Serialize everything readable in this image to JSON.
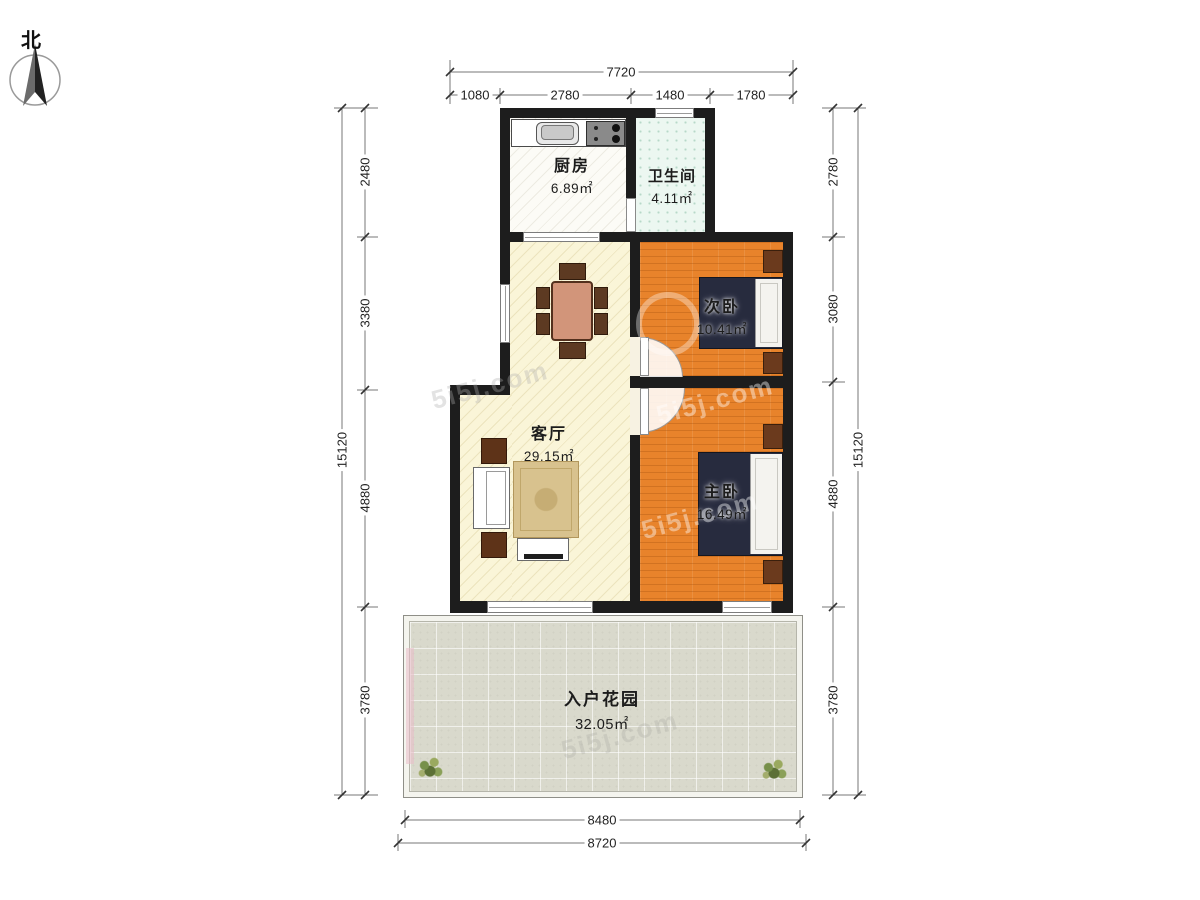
{
  "compass": {
    "north_label": "北"
  },
  "watermark": {
    "text": "5i5j.com"
  },
  "rooms": {
    "kitchen": {
      "name": "厨房",
      "area": "6.89㎡"
    },
    "bathroom": {
      "name": "卫生间",
      "area": "4.11㎡"
    },
    "secondary_bedroom": {
      "name": "次卧",
      "area": "10.41㎡"
    },
    "living_room": {
      "name": "客厅",
      "area": "29.15㎡"
    },
    "master_bedroom": {
      "name": "主卧",
      "area": "16.49㎡"
    },
    "entry_garden": {
      "name": "入户花园",
      "area": "32.05㎡"
    }
  },
  "dimensions": {
    "top": {
      "total": "7720",
      "segments": [
        "1080",
        "2780",
        "1480",
        "1780"
      ]
    },
    "left": {
      "total": "15120",
      "segments": [
        "2480",
        "3380",
        "4880",
        "3780"
      ]
    },
    "right": {
      "total": "15120",
      "segments": [
        "2780",
        "3080",
        "4880",
        "3780"
      ]
    },
    "bottom": {
      "segments": [
        "8480",
        "8720"
      ]
    }
  },
  "colors": {
    "wall": "#1d1d1d",
    "bedroom_floor": "#e8832b",
    "living_floor": "#faf5d8",
    "bathroom_floor": "#ecf7f1",
    "kitchen_floor": "#fcfbf6",
    "garden_floor": "#d9d9cc",
    "bed": "#272b3e"
  }
}
